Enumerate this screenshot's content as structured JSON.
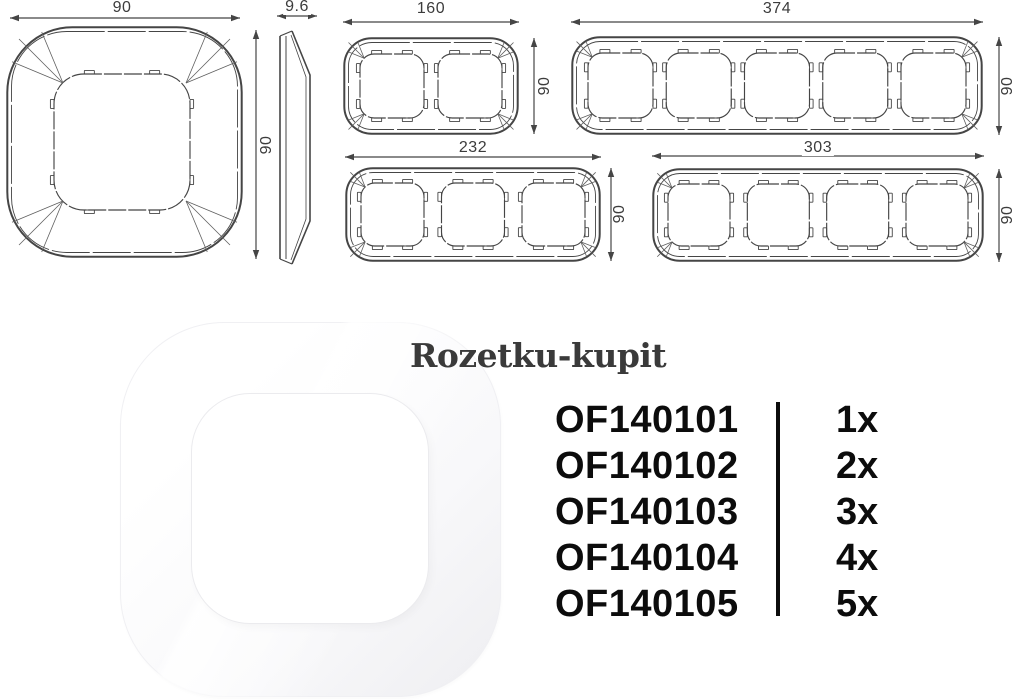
{
  "colors": {
    "line": "#454545",
    "thin_line": "#5f5f5f",
    "dim_text": "#3c3c3c",
    "list_text": "#0c0c0c",
    "title_text": "#3a3a3a"
  },
  "drawings": {
    "front_view": {
      "label": "1-gang frame front view",
      "width_mm": "90",
      "height_mm": "90"
    },
    "side_view": {
      "label": "frame side profile",
      "thickness_mm": "9.6"
    },
    "two_gang": {
      "label": "2-gang frame",
      "gangs": 2,
      "width_mm": "160",
      "height_mm": "90"
    },
    "five_gang": {
      "label": "5-gang frame",
      "gangs": 5,
      "width_mm": "374",
      "height_mm": "90"
    },
    "three_gang": {
      "label": "3-gang frame",
      "gangs": 3,
      "width_mm": "232",
      "height_mm": "90"
    },
    "four_gang": {
      "label": "4-gang frame",
      "gangs": 4,
      "width_mm": "303",
      "height_mm": "90"
    }
  },
  "photo": {
    "label": "white 1-gang frame product photo"
  },
  "watermark": {
    "title": "Rozetku-kupit"
  },
  "product_list": {
    "items": [
      {
        "code": "OF140101",
        "qty": "1x"
      },
      {
        "code": "OF140102",
        "qty": "2x"
      },
      {
        "code": "OF140103",
        "qty": "3x"
      },
      {
        "code": "OF140104",
        "qty": "4x"
      },
      {
        "code": "OF140105",
        "qty": "5x"
      }
    ]
  }
}
